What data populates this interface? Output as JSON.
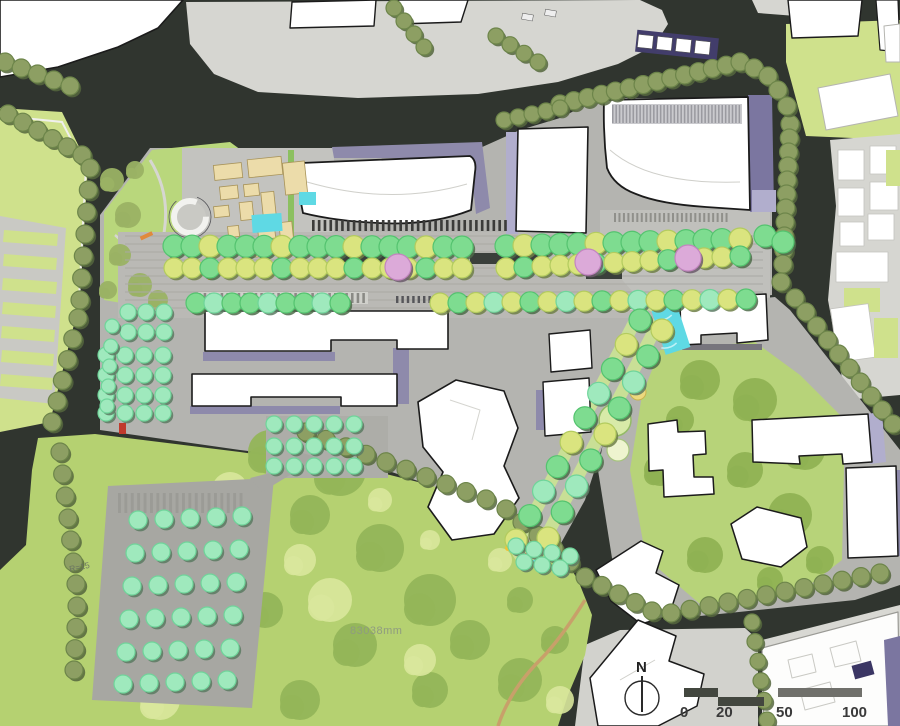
{
  "canvas": {
    "width": 900,
    "height": 726
  },
  "labels": {
    "area_dimension": "83038mm",
    "radius_note": "R=15",
    "north": "N"
  },
  "scalebar": {
    "ticks": [
      "0",
      "20",
      "50",
      "100"
    ]
  },
  "palette": {
    "road": "#30352f",
    "context_gray": "#d6d6d1",
    "site_gray": "#b4b4b0",
    "plaza_gray": "#c3c3bf",
    "mall_gray": "#bab9b5",
    "park_green": "#b5d171",
    "light_green_block": "#cfe18c",
    "courtyard_green": "#b7d379",
    "building_white": "#ffffff",
    "building_outline": "#1b1b1b",
    "shadow_purple": "#8e8aab",
    "shadow_purple_dark": "#7b76a0",
    "shadow_lavender": "#b1aecd",
    "water_cyan": "#5fd9e4",
    "pavilion_tan": "#ecdcaa",
    "path_tan": "#c8a06a"
  },
  "tree_palettes": {
    "olive": {
      "fill": "#8d9f63",
      "rim": "#6d854a",
      "shadow": "#55663d"
    },
    "green": {
      "fill": "#7edc90",
      "rim": "#54c36f",
      "shadow": "#4c6b49"
    },
    "yellow": {
      "fill": "#dae47f",
      "rim": "#b3cb5e",
      "shadow": "#6f7f46"
    },
    "mint": {
      "fill": "#9fe9bd",
      "rim": "#6fd49a",
      "shadow": "#5a7a62"
    },
    "pink": {
      "fill": "#dcaad9",
      "rim": "#c285bf",
      "shadow": "#6b5a6b"
    }
  },
  "tree_rows": [
    {
      "p": "olive",
      "r": 9,
      "x0": 5,
      "y0": 62,
      "x1": 70,
      "y1": 86,
      "n": 5
    },
    {
      "p": "olive",
      "r": 9,
      "x0": 8,
      "y0": 114,
      "x1": 82,
      "y1": 155,
      "n": 6
    },
    {
      "p": "olive",
      "r": 9,
      "x0": 90,
      "y0": 168,
      "x1": 80,
      "y1": 300,
      "n": 7
    },
    {
      "p": "olive",
      "r": 9,
      "x0": 78,
      "y0": 318,
      "x1": 52,
      "y1": 422,
      "n": 6
    },
    {
      "p": "olive",
      "r": 9,
      "x0": 60,
      "y0": 452,
      "x1": 76,
      "y1": 584,
      "n": 7
    },
    {
      "p": "olive",
      "r": 9,
      "x0": 77,
      "y0": 606,
      "x1": 74,
      "y1": 670,
      "n": 4
    },
    {
      "p": "olive",
      "r": 8,
      "x0": 394,
      "y0": 8,
      "x1": 424,
      "y1": 47,
      "n": 4
    },
    {
      "p": "olive",
      "r": 8,
      "x0": 496,
      "y0": 36,
      "x1": 538,
      "y1": 62,
      "n": 4
    },
    {
      "p": "olive",
      "r": 9,
      "x0": 560,
      "y0": 104,
      "x1": 740,
      "y1": 62,
      "n": 14
    },
    {
      "p": "olive",
      "r": 8,
      "x0": 504,
      "y0": 120,
      "x1": 560,
      "y1": 108,
      "n": 5
    },
    {
      "p": "olive",
      "r": 9,
      "x0": 790,
      "y0": 124,
      "x1": 783,
      "y1": 264,
      "n": 11
    },
    {
      "p": "olive",
      "r": 9,
      "x0": 795,
      "y0": 298,
      "x1": 893,
      "y1": 424,
      "n": 10
    },
    {
      "p": "olive",
      "r": 9,
      "x0": 306,
      "y0": 432,
      "x1": 486,
      "y1": 499,
      "n": 10
    },
    {
      "p": "olive",
      "r": 9,
      "x0": 506,
      "y0": 509,
      "x1": 570,
      "y1": 562,
      "n": 5
    },
    {
      "p": "olive",
      "r": 9,
      "x0": 585,
      "y0": 577,
      "x1": 652,
      "y1": 611,
      "n": 5
    },
    {
      "p": "olive",
      "r": 9,
      "x0": 671,
      "y0": 613,
      "x1": 880,
      "y1": 573,
      "n": 12
    },
    {
      "p": "olive",
      "r": 8,
      "x0": 752,
      "y0": 622,
      "x1": 767,
      "y1": 720,
      "n": 6
    },
    {
      "p_cycle": [
        "green",
        "green",
        "yellow",
        "green"
      ],
      "r": 11,
      "x0": 174,
      "y0": 246,
      "x1": 462,
      "y1": 247,
      "n": 17
    },
    {
      "p_cycle": [
        "green",
        "yellow",
        "green",
        "green"
      ],
      "r": 11,
      "x0": 506,
      "y0": 246,
      "x1": 740,
      "y1": 239,
      "n": 14
    },
    {
      "p_cycle": [
        "yellow",
        "yellow",
        "green",
        "yellow"
      ],
      "r": 10,
      "x0": 174,
      "y0": 268,
      "x1": 462,
      "y1": 268,
      "n": 17
    },
    {
      "p_cycle": [
        "yellow",
        "green",
        "yellow",
        "yellow"
      ],
      "r": 10,
      "x0": 506,
      "y0": 268,
      "x1": 740,
      "y1": 256,
      "n": 14
    },
    {
      "p_cycle": [
        "green",
        "mint",
        "green"
      ],
      "r": 10,
      "x0": 196,
      "y0": 303,
      "x1": 340,
      "y1": 303,
      "n": 9
    },
    {
      "p_cycle": [
        "yellow",
        "green",
        "yellow",
        "mint"
      ],
      "r": 10,
      "x0": 440,
      "y0": 303,
      "x1": 746,
      "y1": 299,
      "n": 18
    },
    {
      "p_cycle": [
        "green",
        "yellow",
        "green",
        "mint"
      ],
      "r": 11,
      "x0": 640,
      "y0": 320,
      "x1": 516,
      "y1": 540,
      "n": 10
    },
    {
      "p_cycle": [
        "yellow",
        "green",
        "mint",
        "green"
      ],
      "r": 11,
      "x0": 662,
      "y0": 330,
      "x1": 548,
      "y1": 538,
      "n": 9
    },
    {
      "p": "mint",
      "r": 8,
      "x0": 274,
      "y0": 424,
      "x1": 354,
      "y1": 424,
      "n": 5
    },
    {
      "p": "mint",
      "r": 8,
      "x0": 274,
      "y0": 446,
      "x1": 354,
      "y1": 446,
      "n": 5
    },
    {
      "p": "mint",
      "r": 8,
      "x0": 274,
      "y0": 466,
      "x1": 354,
      "y1": 466,
      "n": 5
    },
    {
      "p": "mint",
      "r": 8,
      "x0": 128,
      "y0": 312,
      "x1": 164,
      "y1": 312,
      "n": 3
    },
    {
      "p": "mint",
      "r": 8,
      "x0": 128,
      "y0": 332,
      "x1": 164,
      "y1": 332,
      "n": 3
    },
    {
      "p": "mint",
      "r": 8,
      "x0": 106,
      "y0": 355,
      "x1": 163,
      "y1": 355,
      "n": 4
    },
    {
      "p": "mint",
      "r": 8,
      "x0": 106,
      "y0": 375,
      "x1": 163,
      "y1": 375,
      "n": 4
    },
    {
      "p": "mint",
      "r": 8,
      "x0": 106,
      "y0": 395,
      "x1": 163,
      "y1": 395,
      "n": 4
    },
    {
      "p": "mint",
      "r": 8,
      "x0": 106,
      "y0": 413,
      "x1": 163,
      "y1": 413,
      "n": 4
    },
    {
      "p": "mint",
      "r": 7,
      "x0": 112,
      "y0": 326,
      "x1": 107,
      "y1": 406,
      "n": 5
    },
    {
      "p": "mint",
      "r": 9,
      "x0": 138,
      "y0": 520,
      "x1": 242,
      "y1": 516,
      "n": 5
    },
    {
      "p": "mint",
      "r": 9,
      "x0": 135,
      "y0": 553,
      "x1": 239,
      "y1": 549,
      "n": 5
    },
    {
      "p": "mint",
      "r": 9,
      "x0": 132,
      "y0": 586,
      "x1": 236,
      "y1": 582,
      "n": 5
    },
    {
      "p": "mint",
      "r": 9,
      "x0": 129,
      "y0": 619,
      "x1": 233,
      "y1": 615,
      "n": 5
    },
    {
      "p": "mint",
      "r": 9,
      "x0": 126,
      "y0": 652,
      "x1": 230,
      "y1": 648,
      "n": 5
    },
    {
      "p": "mint",
      "r": 9,
      "x0": 123,
      "y0": 684,
      "x1": 227,
      "y1": 680,
      "n": 5
    },
    {
      "p": "mint",
      "r": 8,
      "x0": 516,
      "y0": 546,
      "x1": 570,
      "y1": 556,
      "n": 4
    },
    {
      "p": "mint",
      "r": 8,
      "x0": 524,
      "y0": 562,
      "x1": 560,
      "y1": 568,
      "n": 3
    }
  ],
  "tree_points": [
    {
      "p": "pink",
      "r": 13,
      "pts": [
        [
          398,
          267
        ],
        [
          588,
          262
        ],
        [
          688,
          258
        ]
      ]
    },
    {
      "p": "olive",
      "r": 9,
      "pts": [
        [
          754,
          68
        ],
        [
          768,
          76
        ],
        [
          778,
          90
        ],
        [
          787,
          106
        ],
        [
          781,
          282
        ]
      ]
    },
    {
      "p": "green",
      "r": 11,
      "pts": [
        [
          765,
          236
        ],
        [
          783,
          242
        ]
      ]
    }
  ],
  "blobs": [
    {
      "name": "park-dark-masses",
      "fill": "#94b558",
      "opacity": 0.95,
      "pts": [
        [
          270,
          452,
          22
        ],
        [
          340,
          470,
          26
        ],
        [
          310,
          515,
          20
        ],
        [
          380,
          548,
          24
        ],
        [
          430,
          600,
          26
        ],
        [
          355,
          645,
          22
        ],
        [
          265,
          610,
          18
        ],
        [
          470,
          640,
          20
        ],
        [
          520,
          680,
          22
        ],
        [
          200,
          565,
          16
        ],
        [
          430,
          690,
          18
        ],
        [
          300,
          700,
          20
        ],
        [
          555,
          640,
          14
        ],
        [
          520,
          600,
          13
        ]
      ]
    },
    {
      "name": "park-light-patches",
      "fill": "#d9e79c",
      "opacity": 0.9,
      "pts": [
        [
          230,
          490,
          18
        ],
        [
          330,
          600,
          22
        ],
        [
          420,
          660,
          16
        ],
        [
          160,
          700,
          20
        ],
        [
          500,
          560,
          12
        ],
        [
          560,
          700,
          14
        ],
        [
          250,
          540,
          14
        ],
        [
          380,
          500,
          12
        ],
        [
          300,
          560,
          16
        ],
        [
          430,
          540,
          10
        ]
      ]
    },
    {
      "name": "courtyard-masses",
      "fill": "#8fb253",
      "opacity": 0.95,
      "pts": [
        [
          700,
          380,
          20
        ],
        [
          755,
          400,
          22
        ],
        [
          805,
          450,
          20
        ],
        [
          790,
          515,
          22
        ],
        [
          705,
          555,
          18
        ],
        [
          660,
          470,
          16
        ],
        [
          745,
          470,
          18
        ],
        [
          820,
          560,
          14
        ],
        [
          680,
          420,
          14
        ],
        [
          770,
          580,
          13
        ]
      ]
    },
    {
      "name": "nw-park-masses",
      "fill": "#9ab264",
      "opacity": 0.95,
      "pts": [
        [
          112,
          180,
          12
        ],
        [
          128,
          215,
          13
        ],
        [
          120,
          255,
          11
        ],
        [
          140,
          285,
          12
        ],
        [
          158,
          300,
          10
        ],
        [
          108,
          290,
          9
        ],
        [
          135,
          170,
          9
        ]
      ]
    }
  ],
  "patterns": [
    {
      "layer": "under",
      "type": "hlines",
      "x": 125,
      "y": 236,
      "w": 638,
      "h": 78,
      "gap": 8,
      "color": "#a9a9a4"
    },
    {
      "layer": "under",
      "type": "ticks",
      "x": 198,
      "y": 292,
      "w": 170,
      "h": 12,
      "n": 30,
      "color": "#8a8a85",
      "bg": "#d0d0cb"
    },
    {
      "layer": "under",
      "type": "ticks",
      "x": 553,
      "y": 298,
      "w": 88,
      "h": 12,
      "n": 16,
      "color": "#8a8a85",
      "bg": "#d0d0cb"
    },
    {
      "layer": "under",
      "type": "ticks",
      "x": 118,
      "y": 492,
      "w": 128,
      "h": 22,
      "n": 20,
      "color": "#9b9b96",
      "bg": "none"
    },
    {
      "layer": "over",
      "type": "ticks",
      "x": 312,
      "y": 219,
      "w": 198,
      "h": 13,
      "n": 34,
      "color": "#3c3c3a",
      "bg": "none"
    },
    {
      "layer": "over",
      "type": "ticks",
      "x": 612,
      "y": 104,
      "w": 130,
      "h": 20,
      "n": 38,
      "color": "#9a9aa0",
      "bg": "#cacace"
    },
    {
      "layer": "over",
      "type": "ticks",
      "x": 614,
      "y": 212,
      "w": 116,
      "h": 11,
      "n": 26,
      "color": "#90908b",
      "bg": "none"
    },
    {
      "layer": "over",
      "type": "ticks",
      "x": 396,
      "y": 295,
      "w": 108,
      "h": 9,
      "n": 20,
      "color": "#56565a",
      "bg": "none"
    },
    {
      "layer": "over",
      "type": "ticks",
      "x": 545,
      "y": 296,
      "w": 158,
      "h": 9,
      "n": 28,
      "color": "#56565a",
      "bg": "none"
    }
  ]
}
